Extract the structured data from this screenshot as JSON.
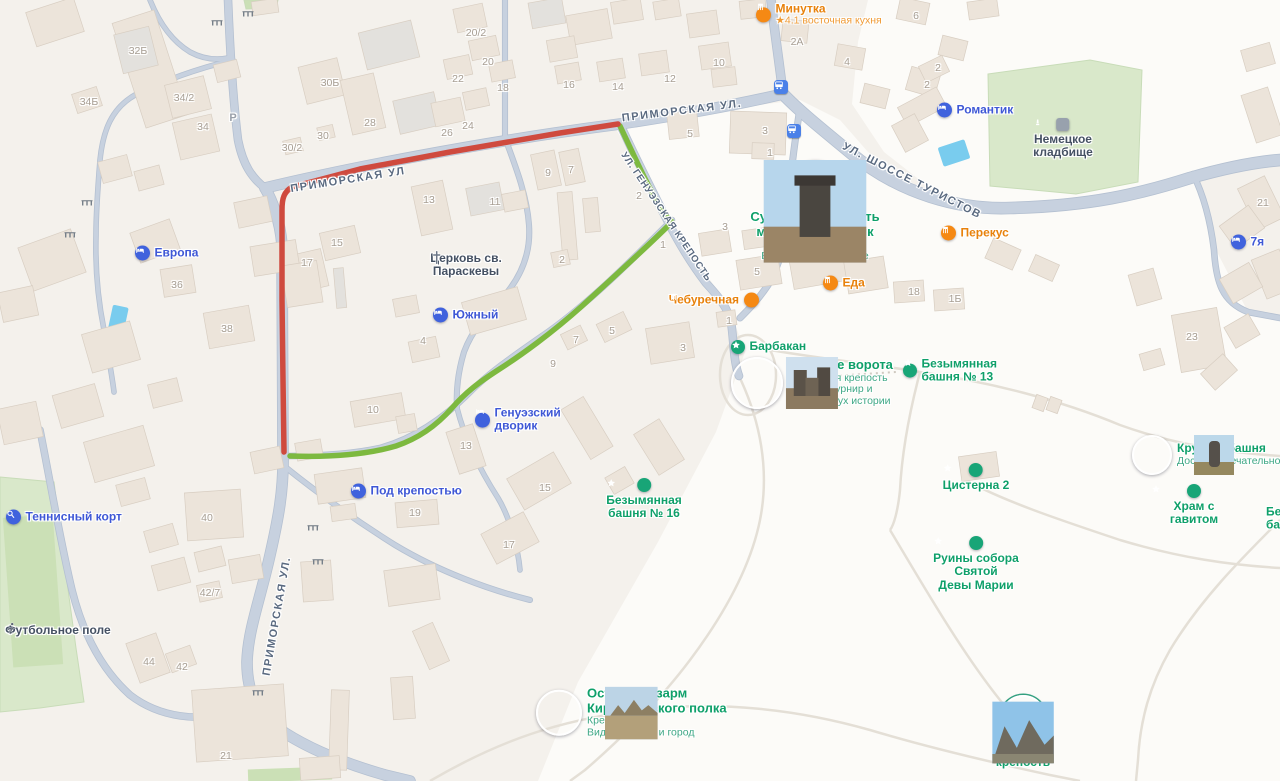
{
  "map": {
    "style": "city-map",
    "language": "ru",
    "area": "Судакская крепость"
  },
  "colors": {
    "land": "#f4f1ec",
    "open_land": "#fcfbf8",
    "road": "#c7d1df",
    "road_casing": "#b4c0d1",
    "path": "#e4dfd6",
    "building": "#ece4da",
    "building_gray": "#e3e1dd",
    "building_stroke": "#d8cec2",
    "green_area": "#d9e8ca",
    "green_area_dark": "#cbe0b6",
    "water": "#79ccee",
    "route_red": "#cf4a3e",
    "route_green": "#7db93f",
    "poi_green": "#0fa06a",
    "poi_green_sub": "#3fa886",
    "poi_blue": "#3f58d6",
    "poi_orange": "#e8820c",
    "poi_orange_sub": "#f09b35",
    "label_dark": "#455163",
    "house_number": "#a79e93",
    "street_label": "#5a6a80",
    "icon_blue": "#4062dd",
    "icon_orange": "#f58914",
    "icon_star": "#18a577",
    "icon_bus": "#4a80e8",
    "icon_monument": "#98a1ad"
  },
  "routes": {
    "red_color": "#cf4a3e",
    "green_color": "#7db93f"
  },
  "streets": [
    {
      "text": "ПРИМОРСКАЯ УЛ",
      "x": 348,
      "y": 180,
      "rot": -9,
      "size": "normal"
    },
    {
      "text": "ПРИМОРСКАЯ УЛ.",
      "x": 682,
      "y": 111,
      "rot": -7,
      "size": "normal"
    },
    {
      "text": "УЛ. ШОССЕ ТУРИСТОВ",
      "x": 912,
      "y": 181,
      "rot": 27,
      "size": "normal"
    },
    {
      "text": "УЛ. ГЕНУЭЗСКАЯ КРЕПОСТЬ",
      "x": 666,
      "y": 217,
      "rot": 56,
      "size": "small"
    },
    {
      "text": "ПРИМОРСКАЯ УЛ.",
      "x": 277,
      "y": 616,
      "rot": -80,
      "size": "normal"
    }
  ],
  "house_numbers": [
    [
      "32Б",
      138,
      51
    ],
    [
      "34Б",
      89,
      102
    ],
    [
      "34/2",
      184,
      98
    ],
    [
      "34",
      203,
      127
    ],
    [
      "30Б",
      330,
      83
    ],
    [
      "28",
      370,
      123
    ],
    [
      "30",
      323,
      136
    ],
    [
      "30/2",
      292,
      148
    ],
    [
      "26",
      447,
      133
    ],
    [
      "24",
      468,
      126
    ],
    [
      "22",
      458,
      79
    ],
    [
      "20/2",
      476,
      33
    ],
    [
      "20",
      488,
      62
    ],
    [
      "18",
      503,
      88
    ],
    [
      "16",
      569,
      85
    ],
    [
      "14",
      618,
      87
    ],
    [
      "12",
      670,
      79
    ],
    [
      "10",
      719,
      63
    ],
    [
      "2А",
      797,
      42
    ],
    [
      "4",
      847,
      62
    ],
    [
      "6",
      916,
      16
    ],
    [
      "2",
      927,
      85
    ],
    [
      "2",
      938,
      68
    ],
    [
      "21",
      1263,
      203
    ],
    [
      "3",
      765,
      131
    ],
    [
      "1",
      770,
      153
    ],
    [
      "5",
      690,
      134
    ],
    [
      "13",
      429,
      200
    ],
    [
      "11",
      495,
      202
    ],
    [
      "9",
      548,
      173
    ],
    [
      "7",
      571,
      170
    ],
    [
      "2",
      639,
      196
    ],
    [
      "15",
      337,
      243
    ],
    [
      "17",
      307,
      263
    ],
    [
      "2",
      562,
      260
    ],
    [
      "5",
      612,
      331
    ],
    [
      "7",
      576,
      340
    ],
    [
      "9",
      553,
      364
    ],
    [
      "4",
      423,
      341
    ],
    [
      "3",
      725,
      227
    ],
    [
      "5",
      757,
      272
    ],
    [
      "18",
      914,
      292
    ],
    [
      "1Б",
      955,
      299
    ],
    [
      "3",
      683,
      348
    ],
    [
      "1",
      729,
      321
    ],
    [
      "36",
      177,
      285
    ],
    [
      "38",
      227,
      329
    ],
    [
      "23",
      1192,
      337
    ],
    [
      "10",
      373,
      410
    ],
    [
      "13",
      466,
      446
    ],
    [
      "15",
      545,
      488
    ],
    [
      "19",
      415,
      513
    ],
    [
      "17",
      509,
      545
    ],
    [
      "40",
      207,
      518
    ],
    [
      "42/7",
      210,
      593
    ],
    [
      "44",
      149,
      662
    ],
    [
      "42",
      182,
      667
    ],
    [
      "21",
      226,
      756
    ],
    [
      "1",
      663,
      245
    ]
  ],
  "markers": {
    "bus_stops": [
      [
        781,
        87
      ],
      [
        794,
        131
      ]
    ],
    "gates": [
      [
        248,
        14
      ],
      [
        217,
        23
      ],
      [
        87,
        203
      ],
      [
        70,
        235
      ],
      [
        313,
        528
      ],
      [
        318,
        562
      ],
      [
        258,
        693
      ]
    ],
    "parking": [
      [
        233,
        118
      ]
    ]
  },
  "pois": [
    {
      "name": "Минутка",
      "subs": [
        "★4.1 восточная кухня"
      ],
      "type": "food",
      "layout": "icon-left",
      "x": 763,
      "y": 15
    },
    {
      "name": "Романтик",
      "type": "hotel",
      "layout": "icon-left",
      "x": 944,
      "y": 110
    },
    {
      "name": "Немецкое\nкладбище",
      "type": "monument",
      "layout": "icon-top",
      "x": 1063,
      "y": 118,
      "color": "dark"
    },
    {
      "name": "Перекус",
      "type": "food",
      "layout": "icon-left",
      "x": 948,
      "y": 233
    },
    {
      "name": "7я",
      "type": "hotel",
      "layout": "icon-left",
      "x": 1238,
      "y": 242
    },
    {
      "name": "Судакская крепость\nмузей-заповедник",
      "subs": [
        "Генуэзская крепость",
        "Виды на город и море"
      ],
      "type": "photo",
      "photo": "tower",
      "psize": 44,
      "layout": "icon-top",
      "x": 815,
      "y": 160,
      "size": "lg"
    },
    {
      "name": "Еда",
      "type": "food",
      "layout": "icon-left",
      "x": 830,
      "y": 283
    },
    {
      "name": "Чебуречная",
      "type": "food",
      "layout": "icon-right",
      "x": 750,
      "y": 300
    },
    {
      "name": "Барбакан",
      "type": "star",
      "layout": "icon-left",
      "x": 738,
      "y": 347
    },
    {
      "name": "Главные ворота",
      "subs": [
        "Генуэзская крепость",
        "Увидеть турнир и",
        "ощутить дух истории"
      ],
      "type": "photo",
      "photo": "gate",
      "psize": 48,
      "layout": "icon-left",
      "x": 755,
      "y": 383,
      "size": "lg"
    },
    {
      "name": "Безымянная\nбашня № 13",
      "type": "star",
      "layout": "icon-left",
      "x": 910,
      "y": 371
    },
    {
      "name": "Круглая башня",
      "subs": [
        "Достопримечательность"
      ],
      "type": "photo",
      "photo": "tower2",
      "psize": 36,
      "layout": "icon-left",
      "x": 1150,
      "y": 455
    },
    {
      "name": "Храм с гавитом",
      "type": "star",
      "layout": "icon-top",
      "x": 1194,
      "y": 484
    },
    {
      "name": "Цистерна 2",
      "type": "star",
      "layout": "icon-top",
      "x": 976,
      "y": 463
    },
    {
      "name": "Безымянная\nбашня № 16",
      "type": "star",
      "layout": "icon-top",
      "x": 644,
      "y": 478
    },
    {
      "name": "Руины собора\nСвятой\nДевы Марии",
      "type": "star",
      "layout": "icon-top",
      "x": 976,
      "y": 536
    },
    {
      "name": "Остатки казарм\nКирилловского полка",
      "subs": [
        "Крепость",
        "Виды на море и город"
      ],
      "type": "photo",
      "photo": "ruins",
      "psize": 42,
      "layout": "icon-left",
      "x": 557,
      "y": 713,
      "size": "lg"
    },
    {
      "name": "Судакская\nкрепость",
      "type": "photo",
      "photo": "fortress",
      "psize": 42,
      "ring": true,
      "layout": "icon-top",
      "x": 1023,
      "y": 695
    },
    {
      "name": "Европа",
      "type": "hotel",
      "layout": "icon-left",
      "x": 142,
      "y": 253
    },
    {
      "name": "Южный",
      "type": "hotel",
      "layout": "icon-left",
      "x": 440,
      "y": 315
    },
    {
      "name": "Генуэзский\nдворик",
      "type": "hotel",
      "layout": "icon-left",
      "x": 482,
      "y": 420
    },
    {
      "name": "Под крепостью",
      "type": "hotel",
      "layout": "icon-left",
      "x": 358,
      "y": 491
    },
    {
      "name": "Теннисный корт",
      "type": "tennis",
      "layout": "icon-left",
      "x": 13,
      "y": 517
    },
    {
      "name": "Футбольное поле",
      "type": "runner",
      "layout": "icon-top",
      "x": 58,
      "y": 622,
      "color": "dark"
    },
    {
      "name": "Церковь св.\nПараскевы",
      "type": "cross",
      "layout": "icon-top",
      "x": 466,
      "y": 250,
      "color": "dark"
    },
    {
      "name": "Безымянная\nбашня",
      "type": "star",
      "layout": "text-only",
      "x": 1266,
      "y": 519
    }
  ]
}
